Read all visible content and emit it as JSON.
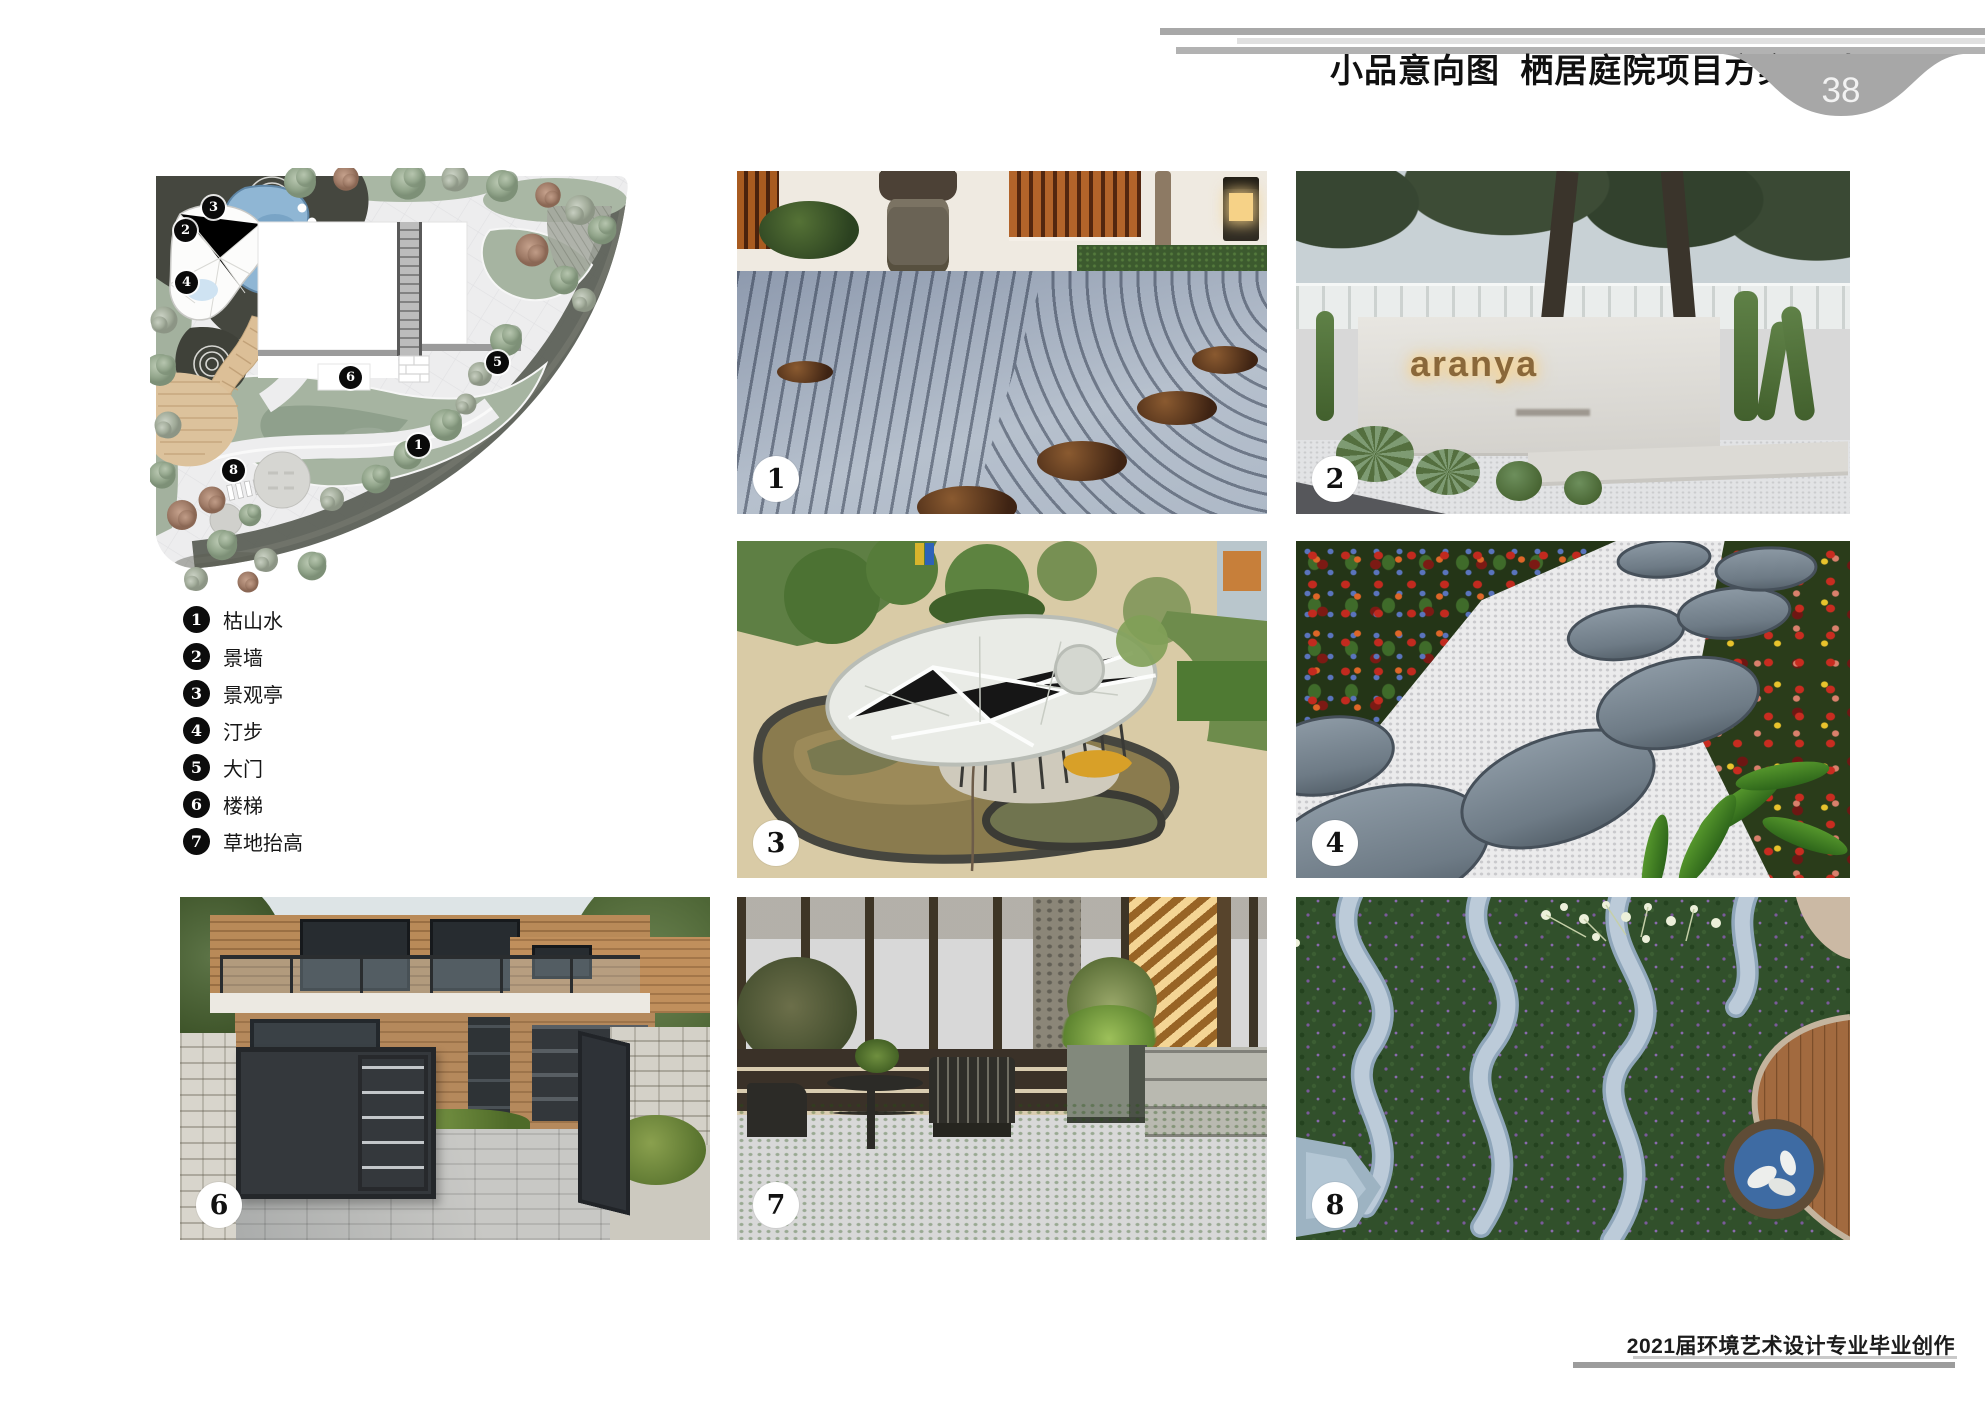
{
  "header": {
    "title": "小品意向图  栖居庭院项目方案设计",
    "page_number": "38"
  },
  "plan": {
    "markers": [
      {
        "num": "1"
      },
      {
        "num": "2"
      },
      {
        "num": "3"
      },
      {
        "num": "4"
      },
      {
        "num": "5"
      },
      {
        "num": "6"
      },
      {
        "num": "8"
      }
    ]
  },
  "legend": {
    "items": [
      {
        "num": "1",
        "label": "枯山水"
      },
      {
        "num": "2",
        "label": "景墙"
      },
      {
        "num": "3",
        "label": "景观亭"
      },
      {
        "num": "4",
        "label": "汀步"
      },
      {
        "num": "5",
        "label": "大门"
      },
      {
        "num": "6",
        "label": "楼梯"
      },
      {
        "num": "7",
        "label": "草地抬高"
      }
    ]
  },
  "photos": [
    {
      "badge": "1"
    },
    {
      "badge": "2",
      "sign_text": "aranya"
    },
    {
      "badge": "3"
    },
    {
      "badge": "4"
    },
    {
      "badge": "6"
    },
    {
      "badge": "7"
    },
    {
      "badge": "8"
    }
  ],
  "footer": {
    "text": "2021届环境艺术设计专业毕业创作"
  }
}
